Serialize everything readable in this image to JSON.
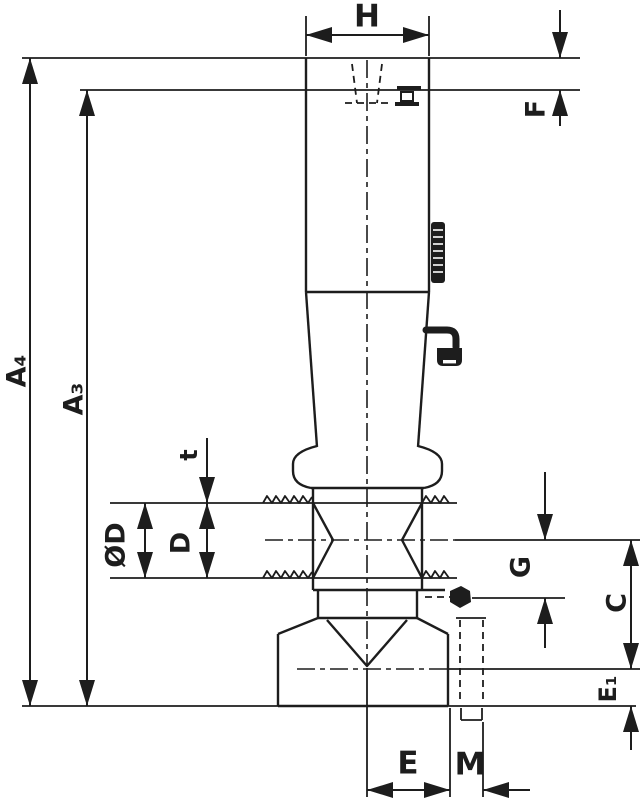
{
  "drawing": {
    "kind": "dimensioned-engineering-drawing",
    "labels": {
      "h": "H",
      "f": "F",
      "a4": "A₄",
      "a3": "A₃",
      "od": "ØD",
      "d": "D",
      "t": "t",
      "g": "G",
      "c": "C",
      "e1": "E₁",
      "e": "E",
      "m": "M"
    },
    "annotations": {
      "thread_zone_marker": "striated-bar",
      "taper_angle_callout": "bent-leader-glyph",
      "socket_detail_callout": "bent-leader-glyph"
    },
    "colors": {
      "line": "#1d1d1d",
      "background": "#ffffff"
    }
  }
}
